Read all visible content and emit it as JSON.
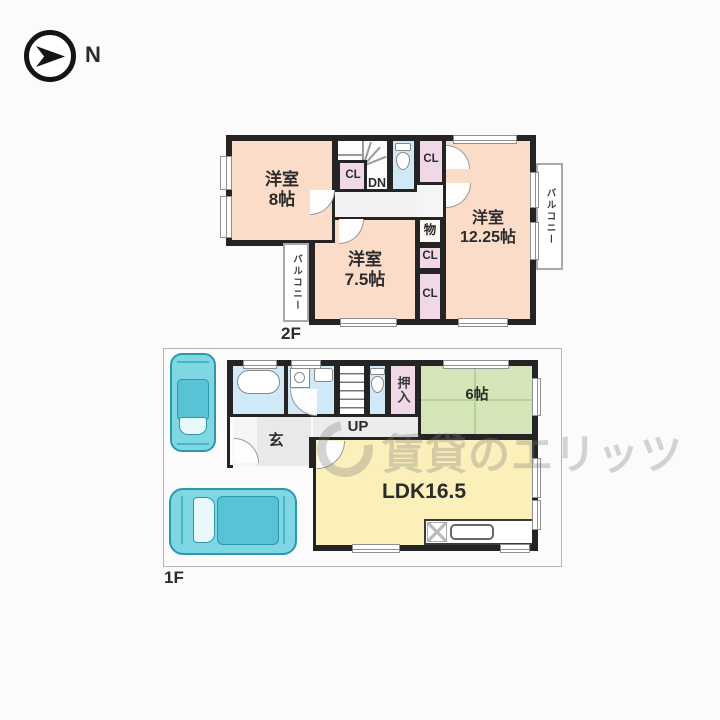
{
  "compass": {
    "label": "N"
  },
  "watermark": {
    "text": "賃貸のエリッツ"
  },
  "floor2": {
    "label": "2F",
    "bedroom8": {
      "name": "洋室",
      "size": "8帖"
    },
    "bedroom1225": {
      "name": "洋室",
      "size": "12.25帖"
    },
    "bedroom75": {
      "name": "洋室",
      "size": "7.5帖"
    },
    "closet_by_stairs": "CL",
    "closet_top_right": "CL",
    "closet_mid": "CL",
    "closet_bottom": "CL",
    "storage": "物",
    "stairs_down": "DN",
    "balcony_left": "バルコニー",
    "balcony_right": "バルコニー"
  },
  "floor1": {
    "label": "1F",
    "genkan": "玄",
    "stairs_up": "UP",
    "oshiire": "押入",
    "tatami6": "6帖",
    "ldk": "LDK16.5"
  },
  "colors": {
    "room_peach": "#fadcc9",
    "closet_pink": "#f1d8e6",
    "water_blue": "#cfe9f6",
    "tatami_green": "#d4e6b8",
    "ldk_yellow": "#fbf0ba",
    "car_teal": "#7ed7e3",
    "wall_dark": "#242424"
  }
}
